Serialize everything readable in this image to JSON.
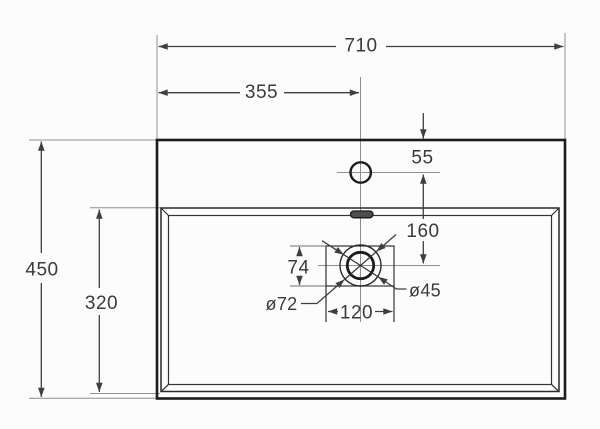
{
  "diagram": {
    "background": "#fcfcfc",
    "colors": {
      "outline": "#1c1c1c",
      "dimension_lines": "#3f3f3f",
      "centerlines": "#8f8f8f",
      "text": "#3a3a3a"
    },
    "labels": {
      "overall_width": "710",
      "center_offset": "355",
      "rim_to_faucet": "55",
      "overall_depth": "450",
      "basin_depth": "320",
      "faucet_to_drain": "160",
      "drain_box_depth": "74",
      "drain_box_width": "120",
      "drain_outer_diameter": "ø72",
      "drain_hole_diameter": "ø45"
    }
  }
}
